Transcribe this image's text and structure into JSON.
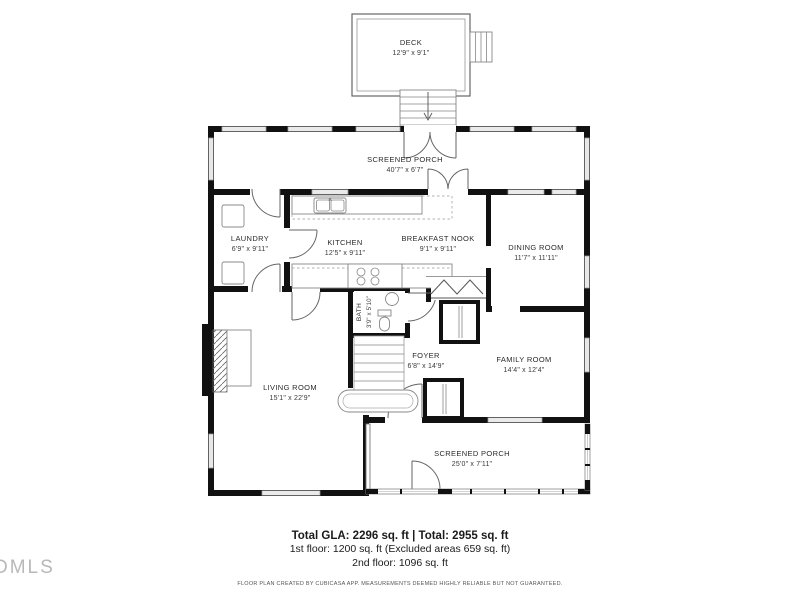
{
  "watermark": "DMLS",
  "rooms": {
    "deck": {
      "name": "DECK",
      "dims": "12'9\" x 9'1\""
    },
    "screened_porch_top": {
      "name": "SCREENED PORCH",
      "dims": "40'7\" x 6'7\""
    },
    "laundry": {
      "name": "LAUNDRY",
      "dims": "6'9\" x 9'11\""
    },
    "kitchen": {
      "name": "KITCHEN",
      "dims": "12'5\" x 9'11\""
    },
    "breakfast_nook": {
      "name": "BREAKFAST NOOK",
      "dims": "9'1\" x 9'11\""
    },
    "dining_room": {
      "name": "DINING ROOM",
      "dims": "11'7\" x 11'11\""
    },
    "bath": {
      "name": "BATH",
      "dims": "3'9\" x 5'10\""
    },
    "foyer": {
      "name": "FOYER",
      "dims": "6'8\" x 14'9\""
    },
    "family_room": {
      "name": "FAMILY ROOM",
      "dims": "14'4\" x 12'4\""
    },
    "living_room": {
      "name": "LIVING ROOM",
      "dims": "15'1\" x 22'9\""
    },
    "screened_porch_bottom": {
      "name": "SCREENED PORCH",
      "dims": "25'0\" x 7'11\""
    }
  },
  "summary": {
    "total": "Total GLA: 2296 sq. ft | Total: 2955 sq. ft",
    "first_floor": "1st floor: 1200 sq. ft (Excluded areas 659 sq. ft)",
    "second_floor": "2nd floor: 1096 sq. ft"
  },
  "disclaimer": "FLOOR PLAN CREATED BY CUBICASA APP. MEASUREMENTS DEEMED HIGHLY RELIABLE BUT NOT GUARANTEED.",
  "colors": {
    "wall": "#111111",
    "background": "#ffffff",
    "line": "#666666",
    "watermark": "#b8b8b8"
  }
}
